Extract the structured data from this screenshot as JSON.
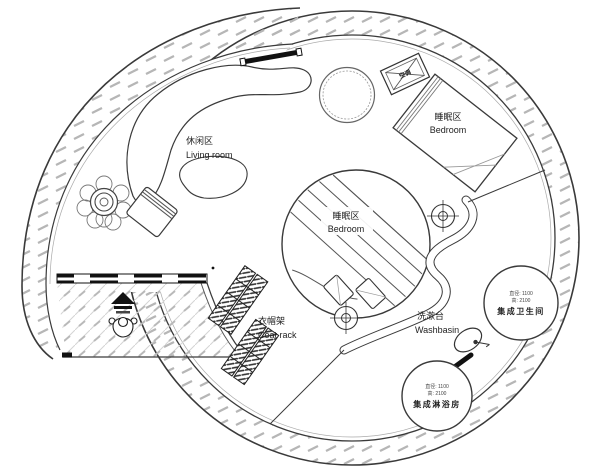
{
  "plan": {
    "areas": {
      "living_room": {
        "label_zh": "休闲区",
        "label_en": "Living room"
      },
      "bedroom_upper": {
        "label_zh": "睡眠区",
        "label_en": "Bedroom"
      },
      "bedroom_center": {
        "label_zh": "睡眠区",
        "label_en": "Bedroom"
      },
      "coat_rack": {
        "label_zh": "衣帽架",
        "label_en": "Coat rack"
      },
      "washbasin": {
        "label_zh": "洗漱台",
        "label_en": "Washbasin"
      },
      "bathroom_pod": {
        "label_zh": "集成卫生间",
        "dim_line1": "直径: 1100",
        "dim_line2": "高: 2100"
      },
      "shower_pod": {
        "label_zh": "集成淋浴房",
        "dim_line1": "直径: 1100",
        "dim_line2": "高: 2100"
      },
      "ac_unit": {
        "label_zh": "空调"
      }
    },
    "colors": {
      "wall_line": "#3a3a3a",
      "hatch": "#b6b6b6",
      "deck_hatch": "#c9c9c9",
      "text": "#222222"
    }
  }
}
